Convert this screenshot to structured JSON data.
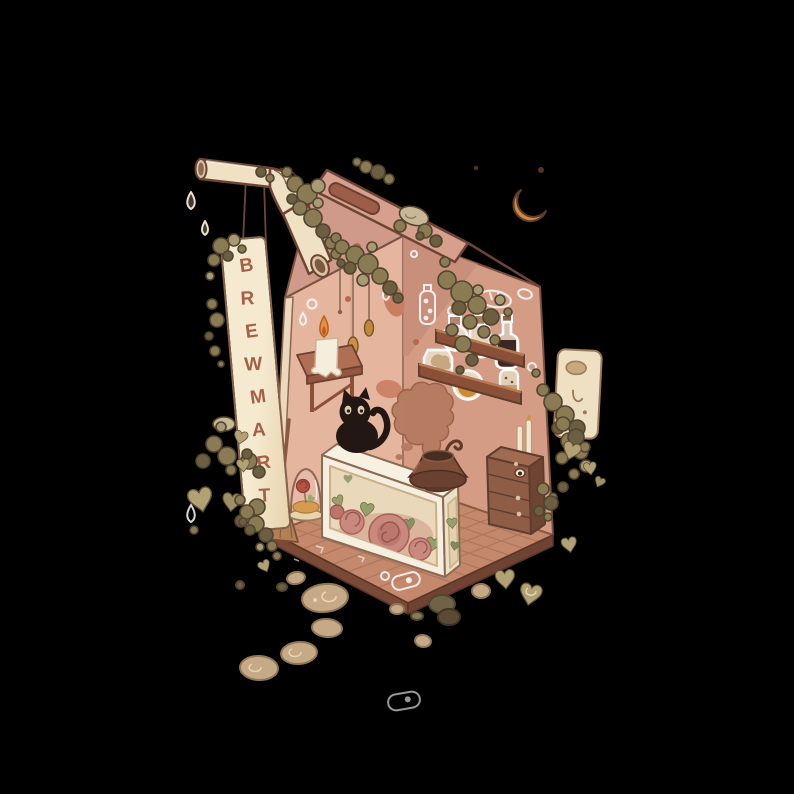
{
  "sign": {
    "text": "BREWMART",
    "letters": [
      "B",
      "R",
      "E",
      "W",
      "M",
      "A",
      "R",
      "T"
    ]
  },
  "scene": {
    "elements": [
      "milk-carton-room",
      "straw-pipe",
      "hanging-brewmart-sign",
      "crescent-moon",
      "black-cat",
      "display-counter-with-roses",
      "cauldron-with-smoke",
      "smoke-cloud",
      "wall-shelf-top",
      "wall-shelf-bottom",
      "potion-flask",
      "amber-bottle",
      "dark-soda-bottle",
      "jar-dough",
      "jar-amber-ball",
      "jar-speckled",
      "candle-stool",
      "melting-candle",
      "chest-of-drawers",
      "taper-candles",
      "bell-jar-rose",
      "broom",
      "hanging-bead-strings",
      "moss-clumps",
      "heart-leaves",
      "stepping-stones",
      "tiled-floor",
      "wall-sticker-doodles",
      "exterior-dispenser-box",
      "water-droplets"
    ],
    "palette": {
      "background": "#000000",
      "outline": "#6d4434",
      "roof_flap": "#d6a08c",
      "upper_wall": "#d09a8a",
      "left_wall": "#e5b59e",
      "right_wall": "#d59c85",
      "wall_shadow": "#c68d78",
      "floor": "#c4886c",
      "floor_line": "#a87054",
      "floor_rim": "#7b4a37",
      "sign_board": "#f2e4c8",
      "sign_letters": "#a55f46",
      "straw": "#f0e0c4",
      "moss": "#8b7b55",
      "moss_dark": "#6b5e41",
      "moss_light": "#a89a74",
      "stone": "#c6a987",
      "heart_leaf": "#b2a174",
      "moon": "#cb8a3e",
      "cat": "#221712",
      "cat_eyes": "#d8cdb0",
      "smoke": "#b57c62",
      "counter": "#f6eede",
      "rose": "#c9897e",
      "rose_leaf": "#97a06b",
      "cauldron": "#7d4f3b",
      "drawers": "#8f5c46",
      "candle_flame": "#e5923a",
      "amber": "#cc8a2e",
      "shelf": "#8a5138",
      "doodle": "#ffffff"
    }
  }
}
